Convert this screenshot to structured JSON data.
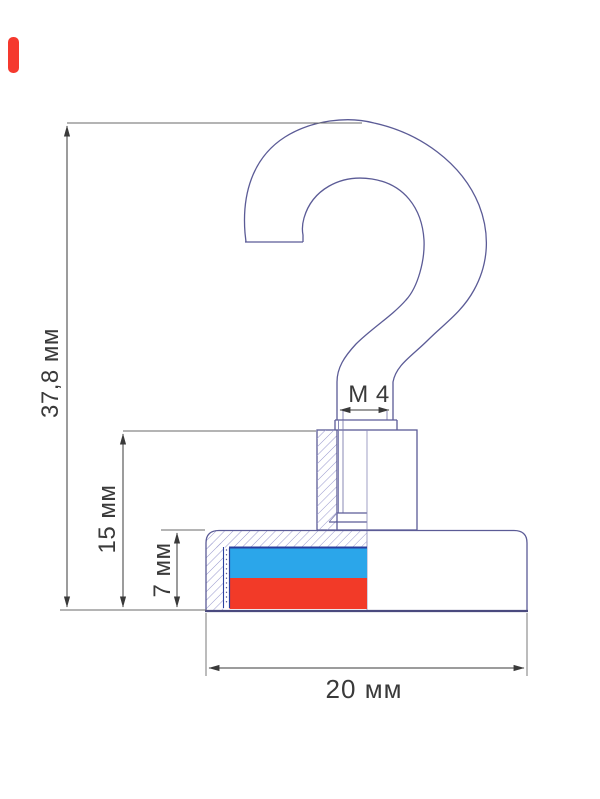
{
  "page": {
    "background": "#ffffff"
  },
  "marker": {
    "color": "#f5392e"
  },
  "drawing": {
    "type": "technical-drawing-magnetic-hook",
    "outline_color": "#5b5b96",
    "hatch_color": "#9a9ace",
    "dimension_color": "#3a3a3a",
    "labels": {
      "total_height": "37,8 мм",
      "stem_height": "15 мм",
      "pot_height": "7 мм",
      "pot_width": "20 мм",
      "thread": "M 4"
    },
    "magnet": {
      "blue": "#2ba6ea",
      "red": "#f23a28",
      "outline": "#2b3f9e"
    }
  }
}
